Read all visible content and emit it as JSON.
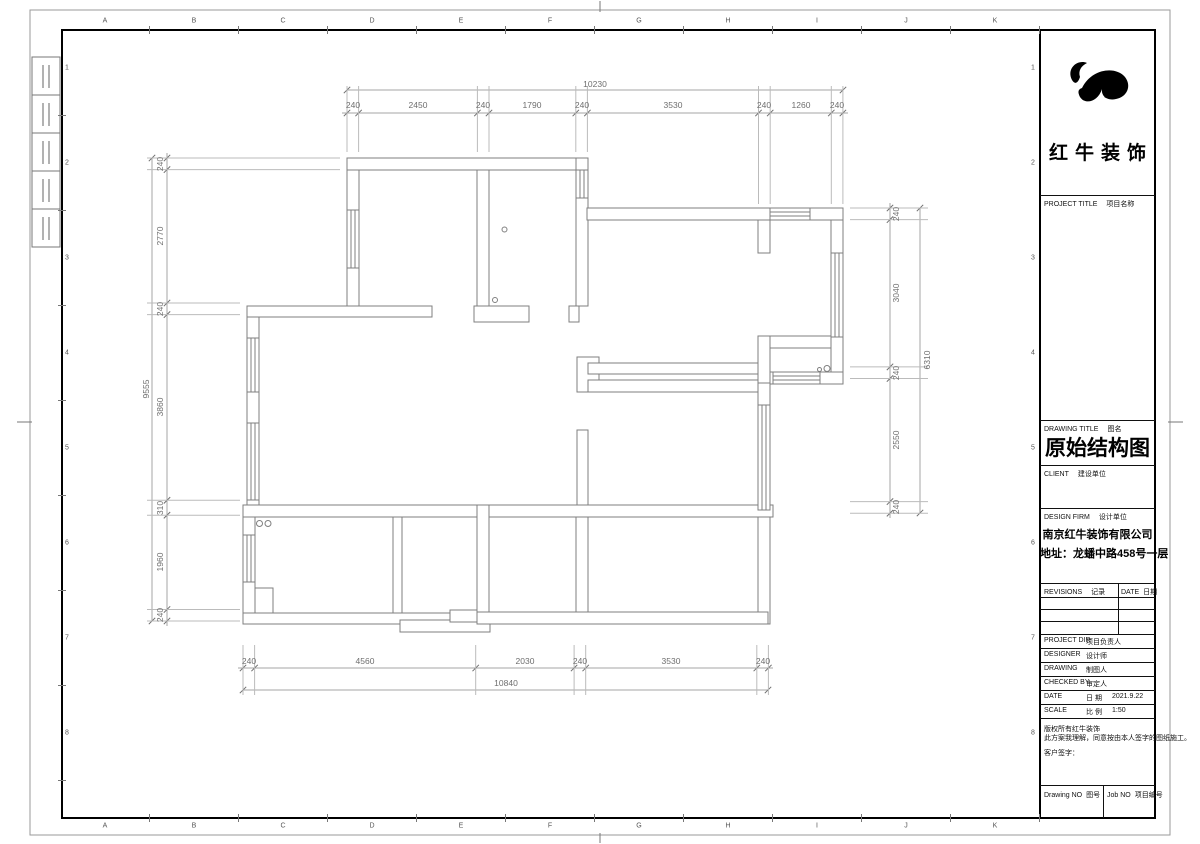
{
  "sheet": {
    "grid_letters": [
      "A",
      "B",
      "C",
      "D",
      "E",
      "F",
      "G",
      "H",
      "I",
      "J",
      "K"
    ],
    "grid_numbers": [
      "1",
      "2",
      "3",
      "4",
      "5",
      "6",
      "7",
      "8"
    ]
  },
  "title_block": {
    "logo_text": "红牛装饰",
    "project_title_label": "PROJECT TITLE",
    "project_title_cn": "项目名称",
    "drawing_title_label": "DRAWING TITLE",
    "drawing_title_cn": "图名",
    "drawing_title": "原始结构图",
    "client_label": "CLIENT",
    "client_cn": "建设单位",
    "design_firm_label": "DESIGN FIRM",
    "design_firm_cn": "设计单位",
    "firm_name": "南京红牛装饰有限公司",
    "firm_address": "地址：龙蟠中路458号一层",
    "revisions_label": "REVISIONS",
    "revisions_cn": "记录",
    "date_header_label": "DATE",
    "date_header_cn": "日期",
    "project_dir_label": "PROJECT DIR",
    "project_dir_cn": "项目负责人",
    "designer_label": "DESIGNER",
    "designer_cn": "设计师",
    "drawing_label": "DRAWING",
    "drawing_cn": "制图人",
    "checked_label": "CHECKED BY",
    "checked_cn": "审定人",
    "date_row_label": "DATE",
    "date_row_cn": "日 期",
    "date_value": "2021.9.22",
    "scale_label": "SCALE",
    "scale_cn": "比 例",
    "scale_value": "1:50",
    "copyright_line1": "版权所有红牛装饰",
    "copyright_line2": "此方案我理解，同意按由本人签字的图纸施工。",
    "customer_sign": "客户签字：",
    "drawing_no_label": "Drawing NO",
    "drawing_no_cn": "图号",
    "job_no_label": "Job NO",
    "job_no_cn": "项目编号"
  },
  "dimensions": {
    "top": {
      "total": "10230",
      "segments": [
        "240",
        "2450",
        "240",
        "1790",
        "240",
        "3530",
        "240",
        "1260",
        "240"
      ]
    },
    "bottom": {
      "total": "10840",
      "segments": [
        "240",
        "4560",
        "2030",
        "240",
        "3530",
        "240"
      ]
    },
    "left": {
      "total": "9555",
      "segments": [
        "240",
        "2770",
        "240",
        "3860",
        "310",
        "1960",
        "240"
      ]
    },
    "right": {
      "total": "6310",
      "segments": [
        "240",
        "3040",
        "240",
        "2550",
        "240"
      ]
    }
  }
}
